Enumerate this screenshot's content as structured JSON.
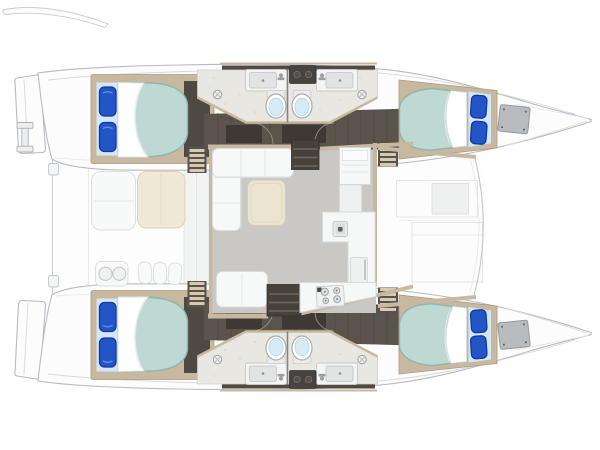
{
  "colors": {
    "hull": "#fcfcfd",
    "hullStroke": "#b7bbbf",
    "deckLine": "#d6d9db",
    "trim": "#c9b8a0",
    "trimDark": "#ab9a82",
    "stepBase": "#57524b",
    "stepStripe": "#d9c9b1",
    "corridor": "#5b544c",
    "corridorDark": "#4f4944",
    "plank": "#46413c",
    "wardrobe": "#3e3934",
    "bathFloor": "#e8e7e2",
    "bathSpeckle": "#d2d0ca",
    "toiletBowl": "#d6ebf4",
    "salonFloor": "#c9c8c4",
    "sofa": "#f7f8f8",
    "sofaStroke": "#dbdedf",
    "tableFill": "#ebe4d0",
    "tableStroke": "#d6cbb0",
    "counter": "#f6f7f7",
    "counterStroke": "#d7dadb",
    "stairFill": "#46413b",
    "stairTread": "#6b6359",
    "mattress": "#bed9d3",
    "mattressEdge": "#8fb5af",
    "pillowZone": "#d3e7f6",
    "pillow": "#2256c7",
    "pillowEdge": "#16379f",
    "locker": "#b9bcbe",
    "lockerStroke": "#94989b",
    "creamSeat": "#efe8d6",
    "creamStroke": "#dcd2bb",
    "darkHatch": "#474340",
    "steel": "#9aa0a2"
  },
  "diagram": {
    "type": "floor-plan",
    "subject": "catamaran yacht deck layout, overhead view",
    "orientation": "bow-right",
    "cabins": [
      {
        "id": "port-aft",
        "bed": "double",
        "pillows": 2
      },
      {
        "id": "port-forward",
        "bed": "double",
        "pillows": 2
      },
      {
        "id": "starboard-aft",
        "bed": "double",
        "pillows": 2
      },
      {
        "id": "starboard-forward",
        "bed": "double",
        "pillows": 2
      }
    ],
    "bathrooms": [
      {
        "id": "port",
        "toilets": 2,
        "sinks": 2,
        "shower_drains": 2
      },
      {
        "id": "starboard",
        "toilets": 2,
        "sinks": 2,
        "shower_drains": 2
      }
    ],
    "salon": {
      "sofa": "L-shaped",
      "coffee_tables": 1,
      "aft_benches": 1,
      "nav_cabinets": 1,
      "companionway_stairwells": 2,
      "hull_step_ladders": 4
    },
    "galley": {
      "sinks": 1,
      "stove_burners": 4,
      "appliance_doors": 1
    },
    "cockpit": {
      "seats": 2,
      "console_cupholders": 2,
      "step_pads": 3,
      "stern_cleats": 2
    },
    "foredeck": {
      "deck_panels": 2,
      "recessed_hatches": 1
    },
    "stern": {
      "transom_platforms": 2,
      "dinghy_davits": 1
    }
  }
}
